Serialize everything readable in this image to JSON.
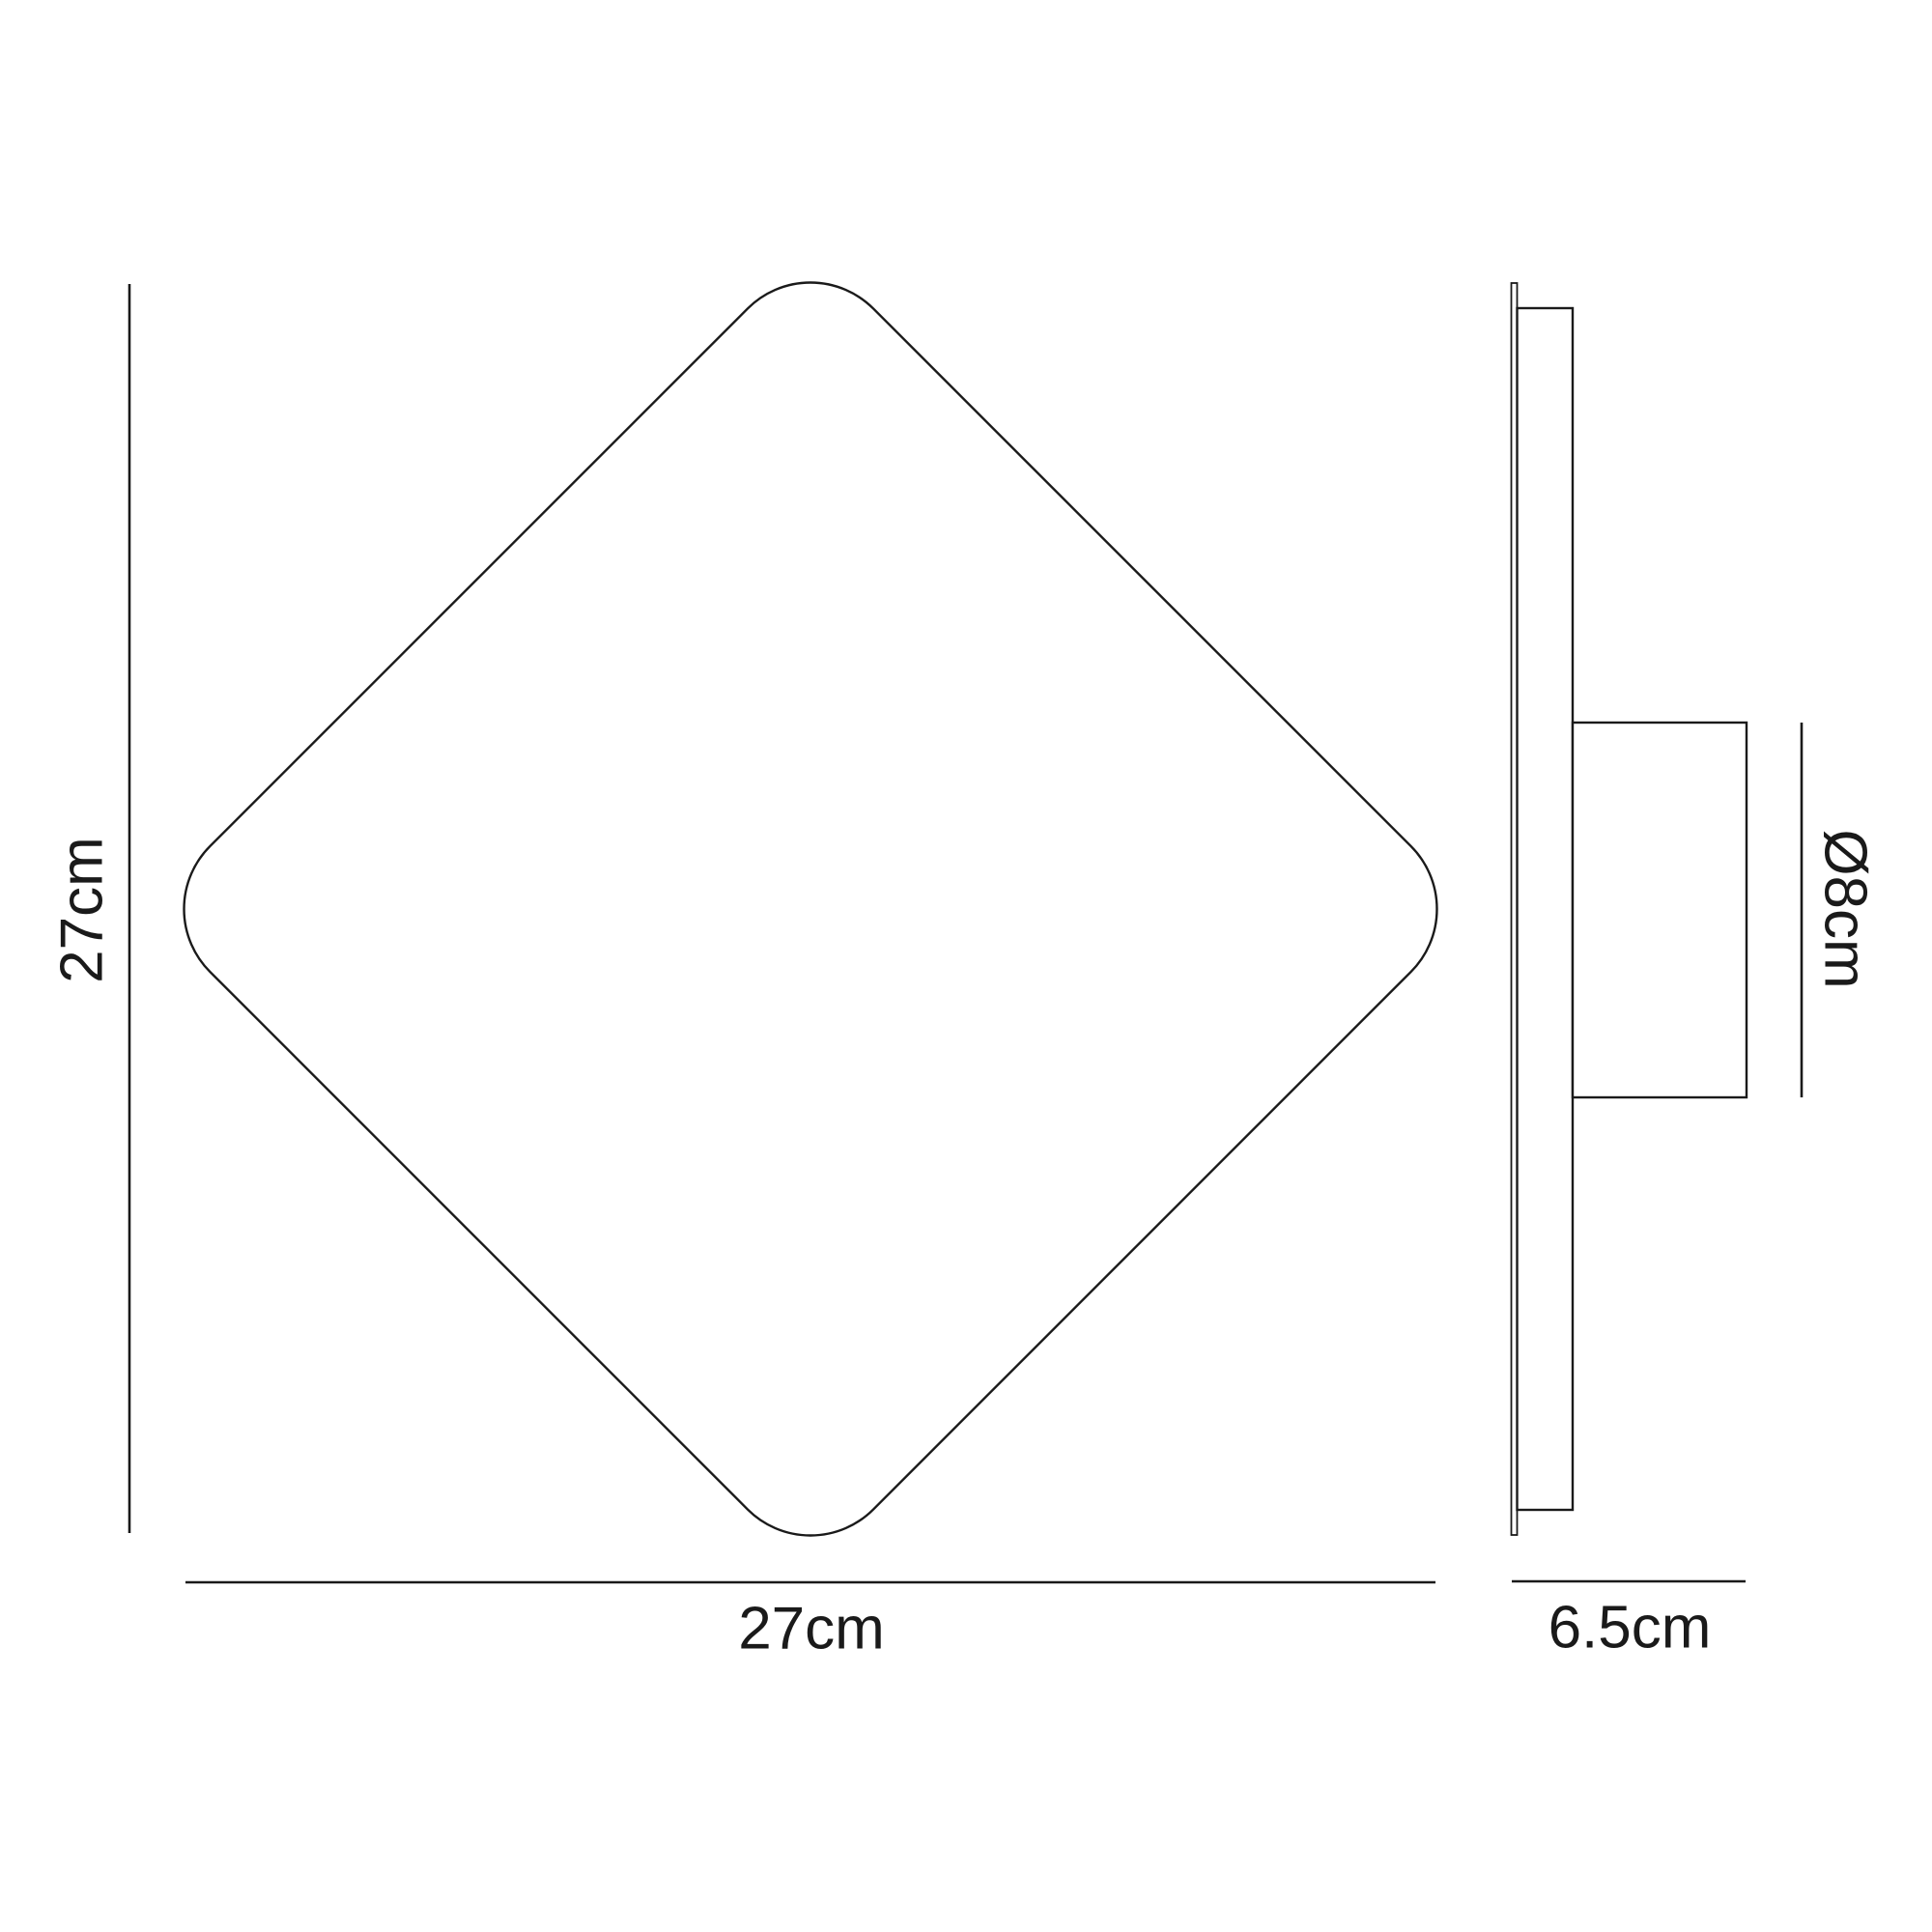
{
  "drawing": {
    "type": "technical-dimension-diagram",
    "subject": "square wall light fixture, front and side elevation",
    "colors": {
      "line": "#1a1a1a",
      "background": "#ffffff"
    },
    "front_view": {
      "height_label": "27cm",
      "width_label": "27cm"
    },
    "side_view": {
      "depth_label": "6.5cm",
      "mount_diameter_label": "Ø8cm"
    }
  }
}
